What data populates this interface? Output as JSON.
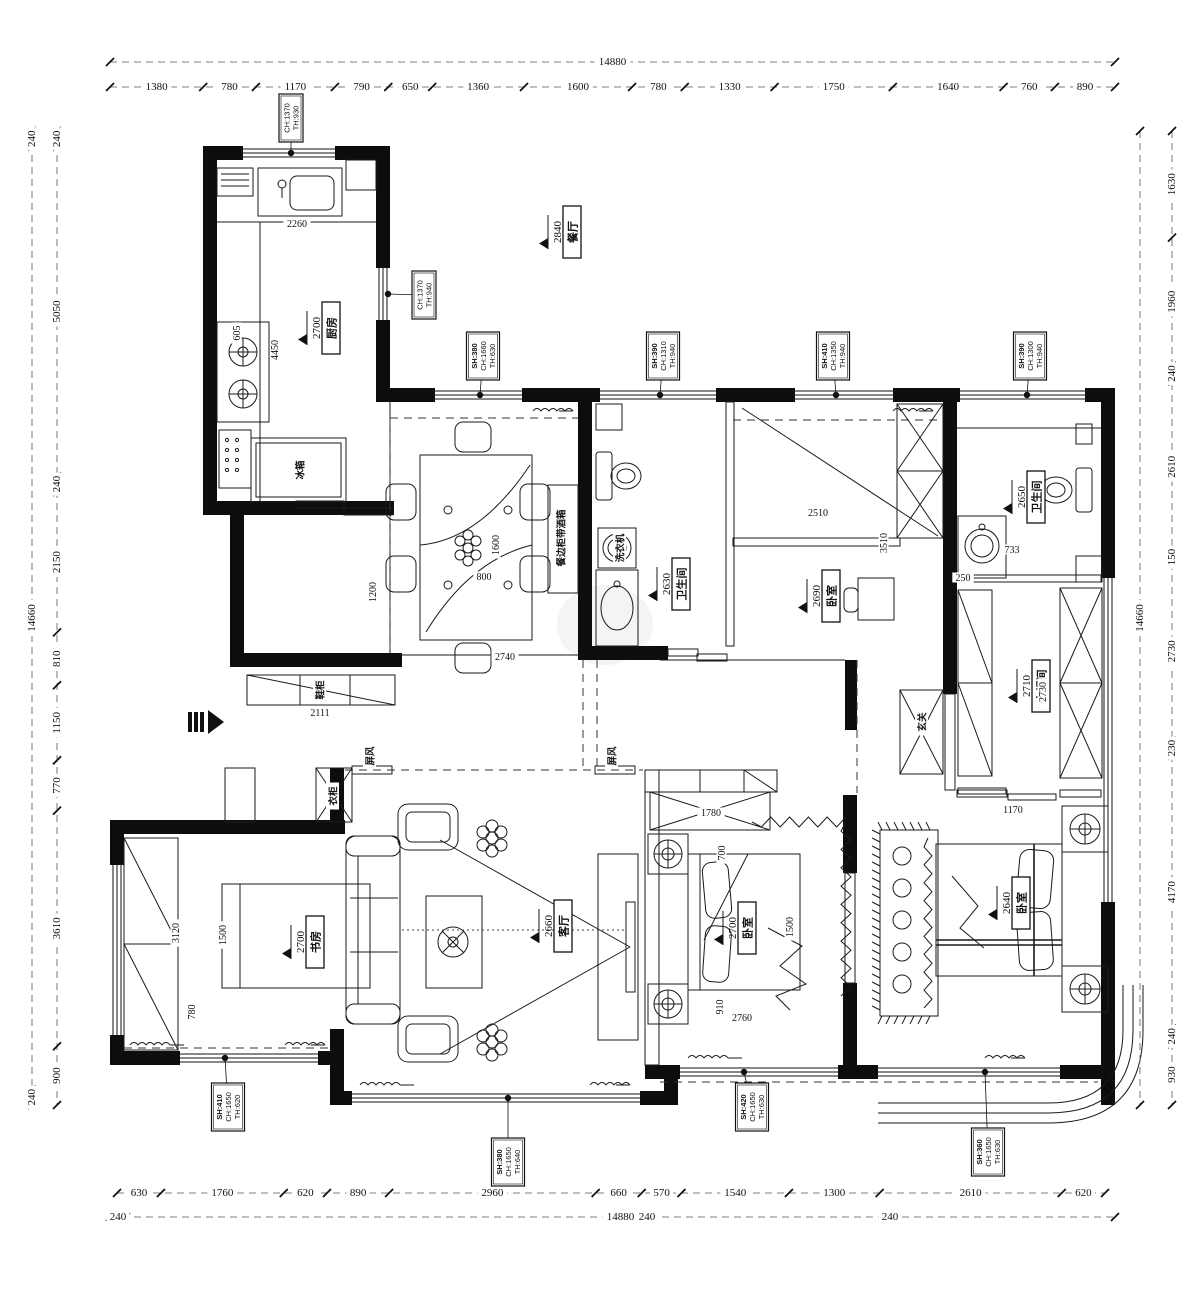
{
  "drawing": {
    "kind": "apartment floor plan"
  },
  "colors": {
    "ink": "#111111",
    "paper": "#ffffff",
    "dim_line": "#555555"
  },
  "dim_chains": [
    {
      "id": "top-overall",
      "side": "top",
      "x1": 110,
      "x2": 1115,
      "y": 62,
      "values": [
        "14880"
      ]
    },
    {
      "id": "top-segments",
      "side": "top",
      "x1": 110,
      "x2": 1115,
      "y": 87,
      "values": [
        "1380",
        "780",
        "1170",
        "790",
        "650",
        "1360",
        "1600",
        "780",
        "1330",
        "1750",
        "1640",
        "760",
        "890"
      ]
    },
    {
      "id": "bottom-segments",
      "side": "bottom",
      "x1": 117,
      "x2": 1105,
      "y": 1193,
      "values": [
        "630",
        "1760",
        "620",
        "890",
        "2960",
        "660",
        "570",
        "1540",
        "1300",
        "2610",
        "620"
      ]
    },
    {
      "id": "bottom-overall",
      "side": "bottom",
      "x1": 110,
      "x2": 1115,
      "y": 1217,
      "values": [
        "240",
        "14880"
      ]
    },
    {
      "id": "left-outer",
      "side": "left",
      "x": 32,
      "y1": 131,
      "y2": 1105,
      "values": [
        "240",
        "14660",
        "240"
      ]
    },
    {
      "id": "left-inner",
      "side": "left",
      "x": 57,
      "y1": 131,
      "y2": 1105,
      "values": [
        "240",
        "5050",
        "240",
        "2150",
        "810",
        "1150",
        "770",
        "3610",
        "900"
      ]
    },
    {
      "id": "right-inner",
      "side": "right",
      "x": 1140,
      "y1": 131,
      "y2": 1105,
      "values": [
        "14660"
      ]
    },
    {
      "id": "right-outer",
      "side": "right",
      "x": 1172,
      "y1": 131,
      "y2": 1105,
      "values": [
        "1630",
        "1960",
        "240",
        "2610",
        "150",
        "2730",
        "230",
        "4170",
        "240",
        "930"
      ]
    }
  ],
  "extra_dims": [
    {
      "text": "240",
      "x": 647,
      "y": 1217,
      "rot": 0
    },
    {
      "text": "240",
      "x": 890,
      "y": 1217,
      "rot": 0
    }
  ],
  "rooms": [
    {
      "name": "厨房",
      "ceiling": "2700",
      "x": 312,
      "y": 328
    },
    {
      "name": "餐厅",
      "ceiling": "2840",
      "x": 553,
      "y": 232
    },
    {
      "name": "卫生间",
      "ceiling": "2630",
      "x": 662,
      "y": 584
    },
    {
      "name": "卧室",
      "ceiling": "2690",
      "x": 812,
      "y": 596
    },
    {
      "name": "卫生间",
      "ceiling": "2650",
      "x": 1017,
      "y": 497
    },
    {
      "name": "衣帽间",
      "ceiling": "2710",
      "x": 1022,
      "y": 686
    },
    {
      "name": "书房",
      "ceiling": "2700",
      "x": 296,
      "y": 942
    },
    {
      "name": "客厅",
      "ceiling": "2660",
      "x": 544,
      "y": 926
    },
    {
      "name": "卧室",
      "ceiling": "2700",
      "x": 728,
      "y": 928
    },
    {
      "name": "卧室",
      "ceiling": "2640",
      "x": 1002,
      "y": 903
    }
  ],
  "areas": [
    {
      "text": "玄关",
      "x": 922,
      "y": 722
    },
    {
      "text": "屏风",
      "x": 370,
      "y": 756
    },
    {
      "text": "屏风",
      "x": 612,
      "y": 756
    },
    {
      "text": "衣柜",
      "x": 333,
      "y": 796
    },
    {
      "text": "冰箱",
      "x": 300,
      "y": 470
    },
    {
      "text": "洗衣机",
      "x": 620,
      "y": 548
    },
    {
      "text": "餐边柜带酒箱",
      "x": 561,
      "y": 538
    },
    {
      "text": "鞋柜",
      "x": 320,
      "y": 690
    }
  ],
  "window_labels": [
    {
      "lines": [
        "CH:1370",
        "TH:930"
      ],
      "bx": 291,
      "by": 118,
      "dx": 291,
      "dy": 153
    },
    {
      "lines": [
        "CH:1370",
        "TH:940"
      ],
      "bx": 424,
      "by": 295,
      "dx": 388,
      "dy": 294
    },
    {
      "lines": [
        "SH:380",
        "CH:1660",
        "TH:630"
      ],
      "bx": 483,
      "by": 356,
      "dx": 480,
      "dy": 395
    },
    {
      "lines": [
        "SH:390",
        "CH:1310",
        "TH:940"
      ],
      "bx": 663,
      "by": 356,
      "dx": 660,
      "dy": 395
    },
    {
      "lines": [
        "SH:410",
        "CH:1350",
        "TH:940"
      ],
      "bx": 833,
      "by": 356,
      "dx": 836,
      "dy": 395
    },
    {
      "lines": [
        "SH:390",
        "CH:1300",
        "TH:940"
      ],
      "bx": 1030,
      "by": 356,
      "dx": 1027,
      "dy": 395
    },
    {
      "lines": [
        "SH:410",
        "CH:1650",
        "TH:620"
      ],
      "bx": 228,
      "by": 1107,
      "dx": 225,
      "dy": 1058
    },
    {
      "lines": [
        "SH:380",
        "CH:1650",
        "TH:640"
      ],
      "bx": 508,
      "by": 1162,
      "dx": 508,
      "dy": 1098
    },
    {
      "lines": [
        "SH:420",
        "CH:1650",
        "TH:630"
      ],
      "bx": 752,
      "by": 1107,
      "dx": 744,
      "dy": 1072
    },
    {
      "lines": [
        "SH:360",
        "CH:1650",
        "TH:630"
      ],
      "bx": 988,
      "by": 1152,
      "dx": 985,
      "dy": 1072
    }
  ],
  "interior_dims": [
    {
      "text": "2260",
      "x": 297,
      "y": 224,
      "rot": 0
    },
    {
      "text": "605",
      "x": 237,
      "y": 333,
      "rot": 90
    },
    {
      "text": "4450",
      "x": 275,
      "y": 350,
      "rot": 90
    },
    {
      "text": "1200",
      "x": 373,
      "y": 592,
      "rot": 90
    },
    {
      "text": "1600",
      "x": 496,
      "y": 545,
      "rot": 90
    },
    {
      "text": "800",
      "x": 484,
      "y": 577,
      "rot": 0
    },
    {
      "text": "2740",
      "x": 505,
      "y": 657,
      "rot": 0
    },
    {
      "text": "2111",
      "x": 320,
      "y": 713,
      "rot": 0
    },
    {
      "text": "2510",
      "x": 818,
      "y": 513,
      "rot": 0
    },
    {
      "text": "3510",
      "x": 884,
      "y": 543,
      "rot": 90
    },
    {
      "text": "733",
      "x": 1012,
      "y": 550,
      "rot": 0
    },
    {
      "text": "250",
      "x": 963,
      "y": 578,
      "rot": 0
    },
    {
      "text": "2730",
      "x": 1043,
      "y": 692,
      "rot": 90
    },
    {
      "text": "1170",
      "x": 1013,
      "y": 810,
      "rot": 0
    },
    {
      "text": "1780",
      "x": 711,
      "y": 813,
      "rot": 0
    },
    {
      "text": "700",
      "x": 722,
      "y": 853,
      "rot": 90
    },
    {
      "text": "1500",
      "x": 790,
      "y": 927,
      "rot": 90
    },
    {
      "text": "910",
      "x": 720,
      "y": 1007,
      "rot": 90
    },
    {
      "text": "2760",
      "x": 742,
      "y": 1018,
      "rot": 0
    },
    {
      "text": "3120",
      "x": 176,
      "y": 933,
      "rot": 90
    },
    {
      "text": "1500",
      "x": 223,
      "y": 935,
      "rot": 90
    },
    {
      "text": "780",
      "x": 192,
      "y": 1012,
      "rot": 90
    }
  ]
}
